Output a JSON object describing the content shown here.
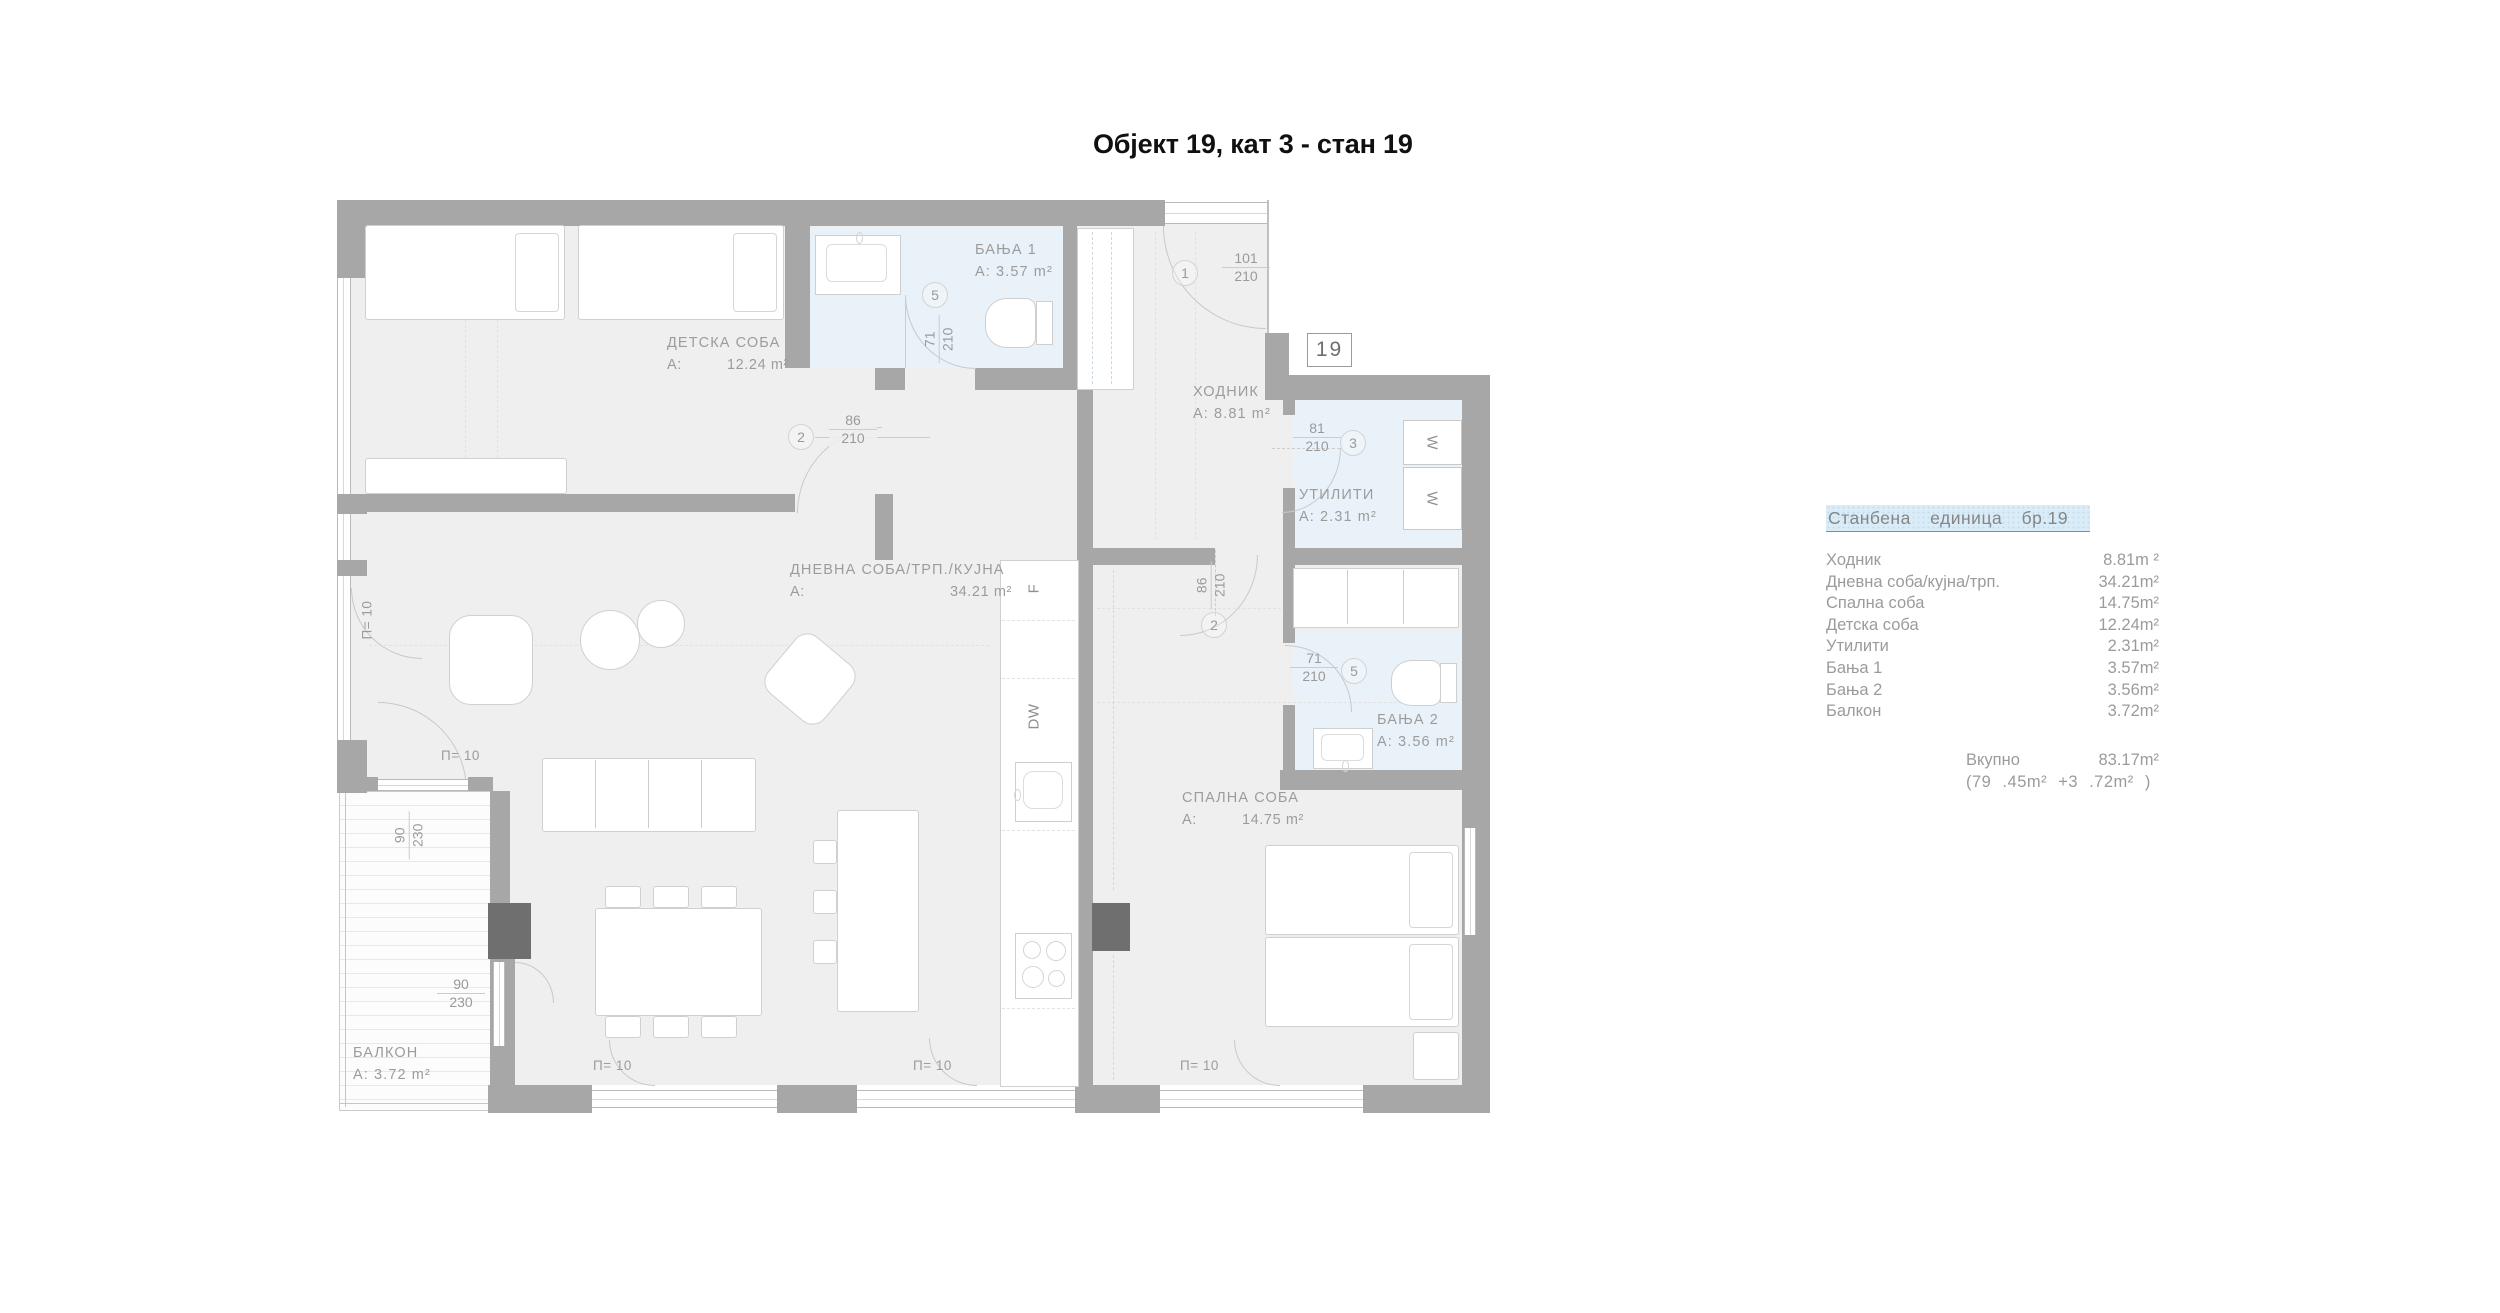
{
  "title": "Објект 19, кат 3 - стан 19",
  "unit_badge": "19",
  "legend": {
    "header": "Станбена единица бр.19",
    "rows": [
      {
        "label": "Ходник",
        "value": "8.81m ²"
      },
      {
        "label": "Дневна соба/кујна/трп.",
        "value": "34.21m²"
      },
      {
        "label": "Спална соба",
        "value": "14.75m²"
      },
      {
        "label": "Детска соба",
        "value": "12.24m²"
      },
      {
        "label": "Утилити",
        "value": "2.31m²"
      },
      {
        "label": "Бања 1",
        "value": "3.57m²"
      },
      {
        "label": "Бања 2",
        "value": "3.56m²"
      },
      {
        "label": "Балкон",
        "value": "3.72m²"
      }
    ],
    "total_label": "Вкупно",
    "total_value": "83.17m²",
    "total_breakdown": "(79 .45m² +3 .72m² )"
  },
  "rooms": {
    "children": {
      "name": "ДЕТСКА СОБА",
      "area_prefix": "A:",
      "area": "12.24 m²"
    },
    "living": {
      "name": "ДНЕВНА СОБА/ТРП./КУЈНА",
      "area_prefix": "A:",
      "area": "34.21 m²"
    },
    "hall": {
      "name": "ХОДНИК",
      "area": "A: 8.81 m²"
    },
    "utility": {
      "name": "УТИЛИТИ",
      "area": "A: 2.31 m²"
    },
    "bath1": {
      "name": "БАЊА 1",
      "area": "A: 3.57 m²"
    },
    "bath2": {
      "name": "БАЊА 2",
      "area": "A: 3.56 m²"
    },
    "bedroom": {
      "name": "СПАЛНА СОБА",
      "area_prefix": "A:",
      "area": "14.75 m²"
    },
    "balcony": {
      "name": "БАЛКОН",
      "area": "A: 3.72 m²"
    }
  },
  "dims": {
    "entry": {
      "tag": "1",
      "w": "101",
      "h": "210"
    },
    "children_door": {
      "tag": "2",
      "w": "86",
      "h": "210"
    },
    "bedroom_door": {
      "tag": "2",
      "w": "86",
      "h": "210"
    },
    "utility_door": {
      "tag": "3",
      "w": "81",
      "h": "210"
    },
    "bath1_door": {
      "tag": "5",
      "w": "71",
      "h": "210"
    },
    "bath2_door": {
      "tag": "5",
      "w": "71",
      "h": "210"
    },
    "balcony_door1": {
      "w": "90",
      "h": "230"
    },
    "balcony_door2": {
      "w": "90",
      "h": "230"
    },
    "window_label": "П= 10"
  },
  "appliances": {
    "washer": "W",
    "fridge": "F",
    "dishwasher": "DW"
  },
  "colors": {
    "wall": "#a7a7a7",
    "pillar": "#6f6f6f",
    "floor": "#f0efef",
    "bath": "#e9f2f8",
    "highlight": "#d9ecf7"
  }
}
